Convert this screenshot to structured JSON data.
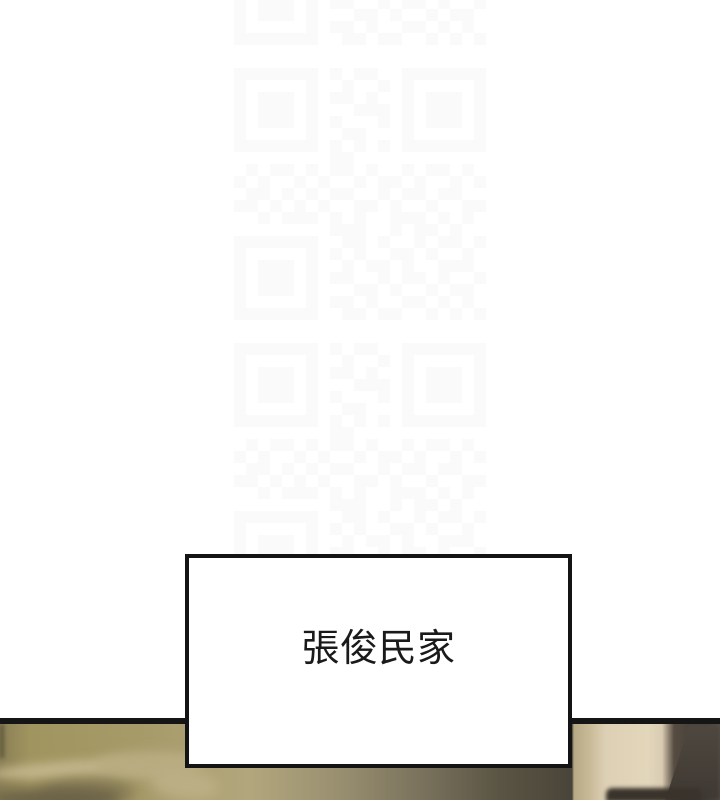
{
  "page": {
    "background_color": "#ffffff"
  },
  "caption": {
    "text": "張俊民家",
    "text_color": "#1a1a1a",
    "box_background": "#ffffff",
    "box_border_color": "#141414"
  },
  "divider": {
    "color": "#151515"
  },
  "watermark": {
    "kind": "qr-code",
    "module_color": "#fafafa",
    "rows": [
      "111111101011001111111",
      "100000100100101000001",
      "101110101101001011101",
      "101110100011101011101",
      "101110101000101011101",
      "100000100110001000001",
      "111111101010101111111",
      "000000001100000000000",
      "010110101101001011010",
      "101001010010110100101",
      "011010101100101101100",
      "110101010011010010011",
      "001011101010011101010",
      "000000001110010110100",
      "111111100110100101101",
      "100000101010011010010",
      "101110100101101001110",
      "101110101100101101001",
      "101110100011010010110",
      "100000101101001101010",
      "111111100110110010101"
    ]
  },
  "photo": {
    "palette": {
      "bedding_khaki": "#a79b6a",
      "pillow_highlight": "#c4b68c",
      "center_shadow": "#49443a",
      "wall_cream": "#e2d6bb",
      "wall_tan_strip": "#c9ba98",
      "furniture_dark": "#4a433b",
      "object_dark": "#39332c"
    }
  }
}
